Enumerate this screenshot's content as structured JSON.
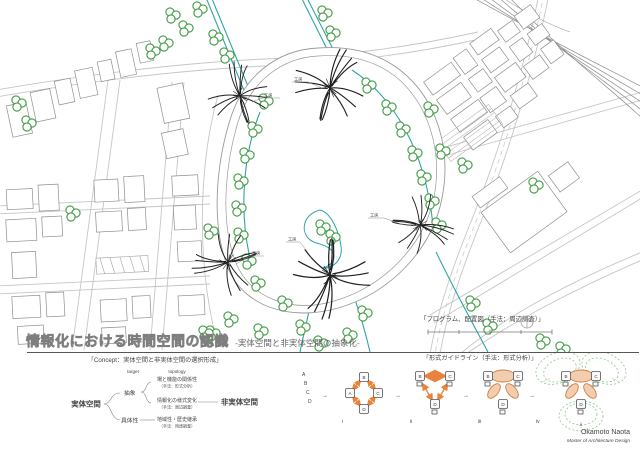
{
  "title_block": {
    "title": "情報化における時間空間の認識",
    "subtitle": "-実体空間と非実体空間の抽象化-"
  },
  "map": {
    "caption": "「プログラム、配置図（手法：周辺調査）」",
    "structure_labels": [
      "工房",
      "工房",
      "工房",
      "工房",
      "工房"
    ]
  },
  "concept": {
    "caption": "「Concept：実体空間と非実体空間の選択形成」",
    "headers": {
      "left": "target",
      "right": "topology"
    },
    "source": "実体空間",
    "sink": "非実体空間",
    "branch_top": "抽象",
    "branch_bottom": "具体性",
    "items": [
      {
        "title": "場と機能の関係性",
        "method": "（手法：形式分析）"
      },
      {
        "title": "情報化の様式変化",
        "method": "（手法：周辺調査）"
      },
      {
        "title": "地域性・歴史継承",
        "method": "（手法：用途調査）"
      }
    ]
  },
  "guideline": {
    "caption": "「形式ガイドライン（手法：形式分析）」",
    "sequence": [
      "A",
      "B",
      "C",
      "D"
    ],
    "arrow": "→",
    "stage_labels": [
      "i",
      "ii",
      "iii",
      "iv"
    ],
    "nodes": {
      "a": "A",
      "b": "B",
      "c": "C",
      "d": "D"
    },
    "annotation": "A"
  },
  "signature": {
    "name": "Okamoto Naota",
    "title": "Master of Architecture Design"
  },
  "colors": {
    "tree": "#3f9b43",
    "canal": "#2fa3a8",
    "road": "#c6c6c6",
    "building": "#8f8f8f",
    "sketch": "#1f1f1f",
    "orange": "#e8823c",
    "ellipse_fill": "#f3cdb0",
    "ellipse_stroke": "#cf7f3f",
    "green_dash": "#8bc88b",
    "title_gray": "#8a8a8a"
  }
}
